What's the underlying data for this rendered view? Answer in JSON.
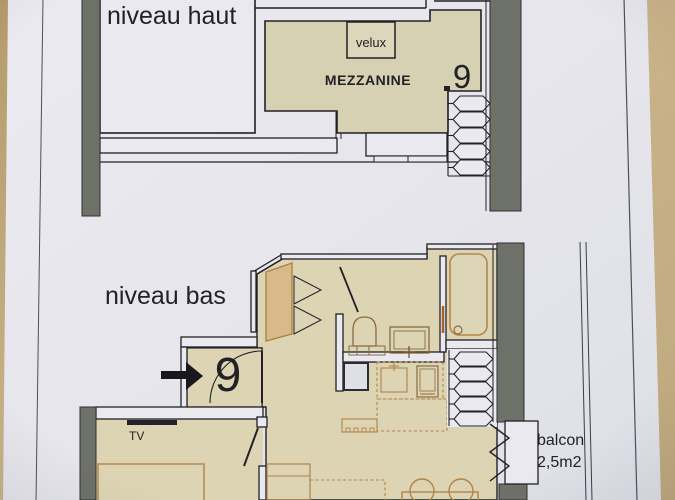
{
  "upper_level": {
    "title": "niveau haut",
    "room_label": "MEZZANINE",
    "skylight_label": "velux",
    "unit_number": "9"
  },
  "lower_level": {
    "title": "niveau bas",
    "entry_arrow": "→",
    "unit_number": "9",
    "tv_label": "TV",
    "balcony_label": "balcon",
    "balcony_area": "2,5m2"
  },
  "colors": {
    "paper": "#e6e6ec",
    "paper_light": "#e9e9ef",
    "room_fill": "#d7d1b3",
    "room_fill_warm": "#dcd4b2",
    "wall_gray": "#6e7168",
    "line_black": "#212127",
    "furniture_tan": "#b1854a",
    "furniture_dark": "#8a6b40",
    "wardrobe_fill": "#d8b98a",
    "table_left": "#a8905f",
    "table_right": "#cbb58b"
  }
}
